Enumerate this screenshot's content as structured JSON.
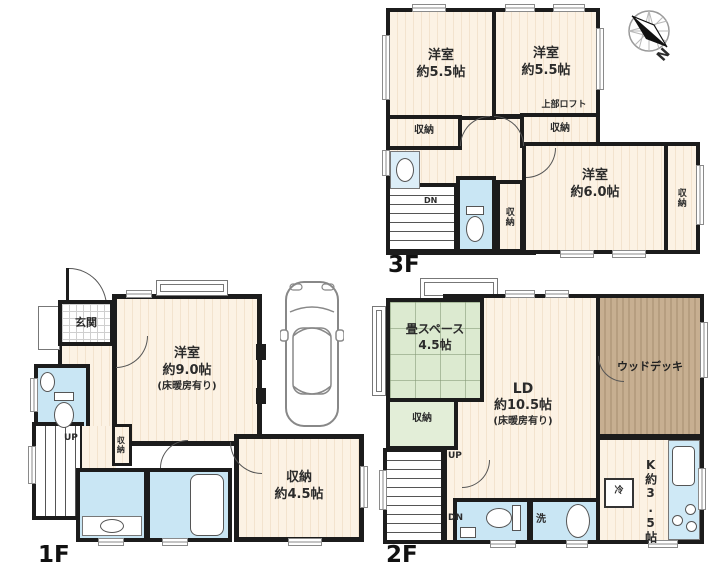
{
  "common": {
    "closet": "収納",
    "up": "UP",
    "dn": "DN",
    "north": "N"
  },
  "floor3": {
    "label": "3F",
    "room_a": {
      "name": "洋室",
      "size": "約5.5帖"
    },
    "room_b": {
      "name": "洋室",
      "size": "約5.5帖"
    },
    "loft_note": "上部ロフト",
    "room_c": {
      "name": "洋室",
      "size": "約6.0帖"
    }
  },
  "floor2": {
    "label": "2F",
    "tatami": {
      "name": "畳スペース",
      "size": "4.5帖"
    },
    "ld": {
      "name": "LD",
      "size": "約10.5帖",
      "note": "(床暖房有り)"
    },
    "deck": "ウッドデッキ",
    "kitchen": {
      "name": "K",
      "size": "約3.5帖"
    },
    "wash": "洗",
    "fridge": "冷"
  },
  "floor1": {
    "label": "1F",
    "entrance": "玄関",
    "main": {
      "name": "洋室",
      "size": "約9.0帖",
      "note": "(床暖房有り)"
    },
    "storage": {
      "name": "収納",
      "size": "約4.5帖"
    }
  },
  "colors": {
    "wall": "#1c1c1c",
    "floor_wood": "#fcf2e4",
    "wet_blue": "#c9e6f4",
    "tatami_green": "#dcead0",
    "deck_brown": "#c3ab8d"
  }
}
